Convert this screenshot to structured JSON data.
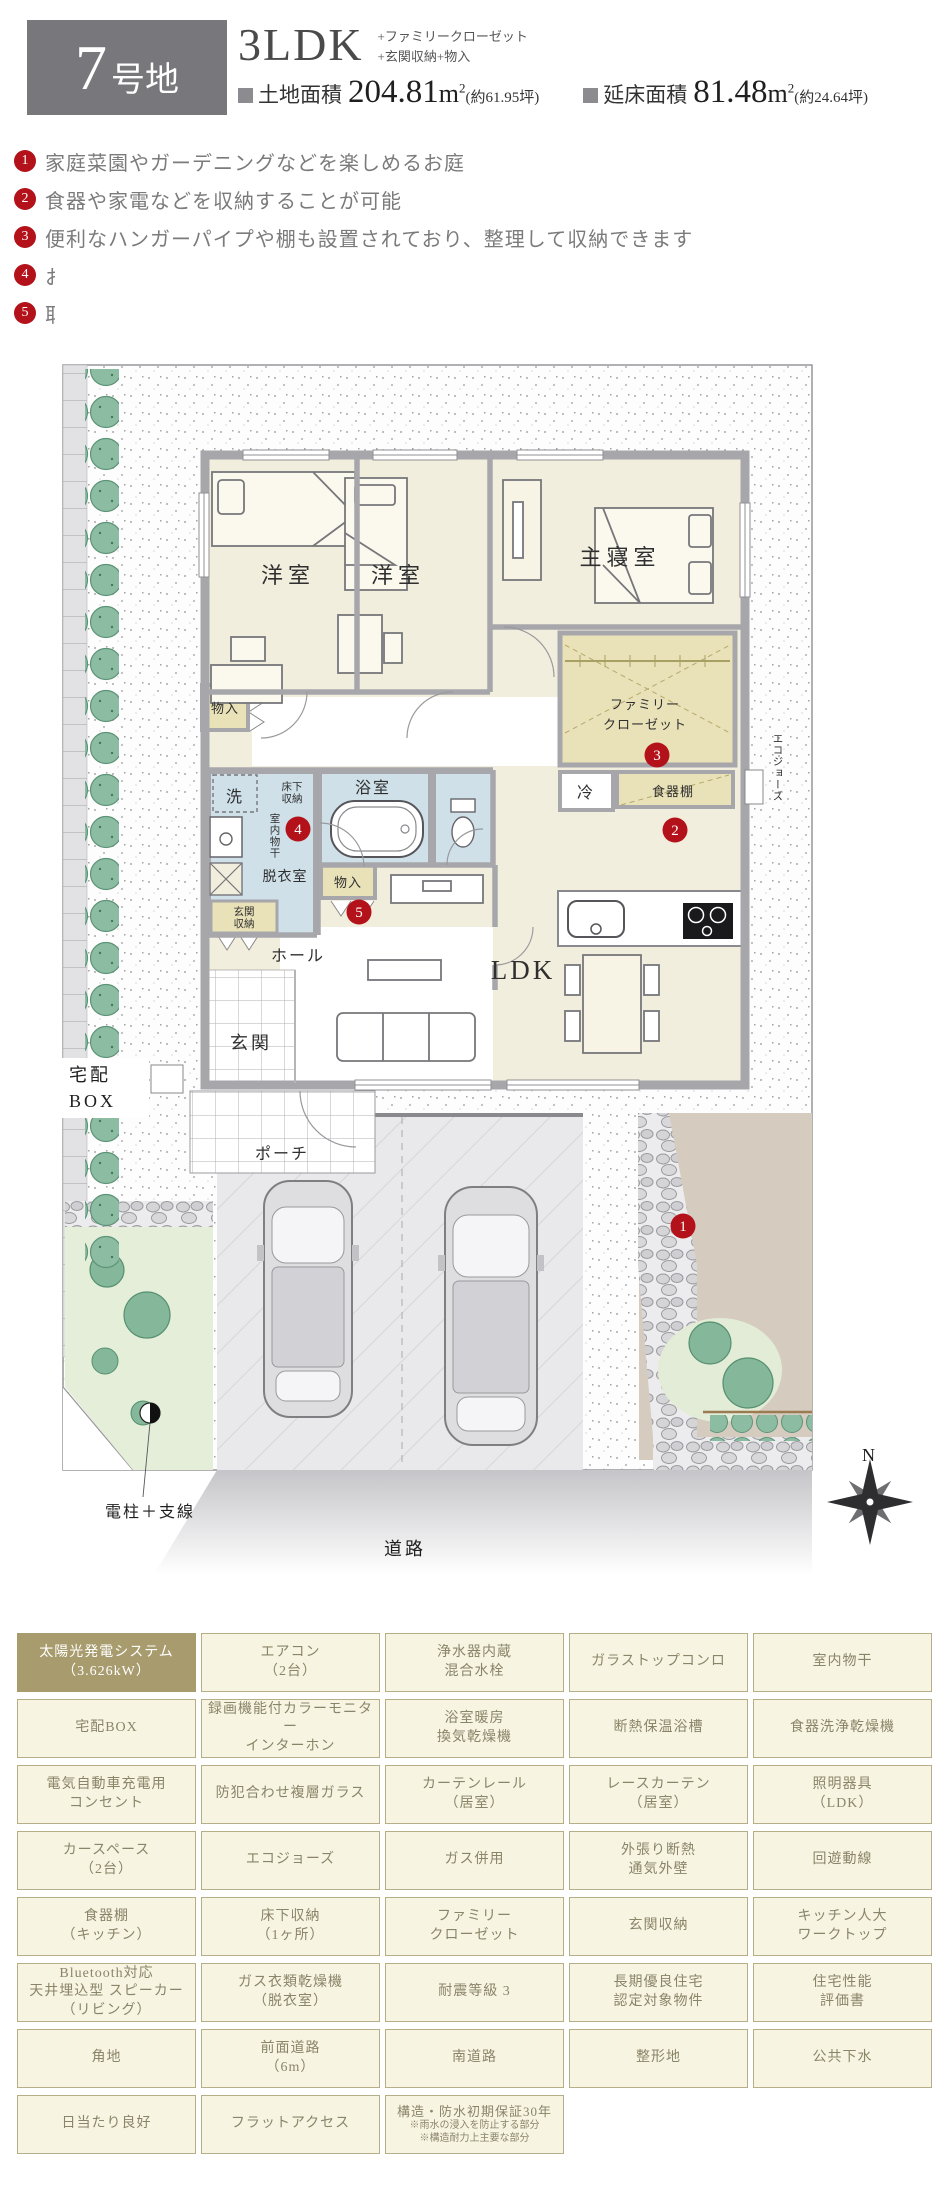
{
  "header": {
    "lot_number": "7",
    "lot_suffix": "号地",
    "plan_type": "3LDK",
    "plan_extra1": "+ファミリークローゼット",
    "plan_extra2": "+玄関収納+物入",
    "land_label": "土地面積",
    "land_value": "204.81",
    "unit": "m",
    "unit_sup": "2",
    "land_tsubo": "(約61.95坪)",
    "floor_label": "延床面積",
    "floor_value": "81.48",
    "floor_tsubo": "(約24.64坪)"
  },
  "features_list": [
    {
      "num": "1",
      "text": "家庭菜園やガーデニングなどを楽しめるお庭"
    },
    {
      "num": "2",
      "text": "食器や家電などを収納することが可能"
    },
    {
      "num": "3",
      "text": "便利なハンガーパイプや棚も設置されており、整理して収納できます"
    },
    {
      "num": "4",
      "text": "お天気が悪い日にも、洗濯物を干す場所に困らない室内物干"
    },
    {
      "num": "5",
      "text": "取り出しやすく、室内を綺麗に整理するのに役立つ物入"
    }
  ],
  "plan": {
    "yoshitsu": "洋室",
    "shushinshitsu": "主寝室",
    "fc1": "ファミリー",
    "fc2": "クローゼット",
    "rei": "冷",
    "shokkidana": "食器棚",
    "eco": "エコジョーズ",
    "monoire": "物入",
    "sen": "洗",
    "yukashita1": "床下",
    "yukashita2": "収納",
    "indoor_dry": "室内物干",
    "datsui": "脱衣室",
    "yokushitsu": "浴室",
    "gshuno1": "玄関",
    "gshuno2": "収納",
    "hall": "ホール",
    "genkan": "玄関",
    "porch": "ポーチ",
    "takuhai1": "宅配",
    "takuhai2": "BOX",
    "ldk": "LDK",
    "road": "道路",
    "pole": "電柱＋支線",
    "north": "N"
  },
  "features_table": {
    "cells": [
      {
        "lines": [
          "太陽光発電システム",
          "（3.626kW）"
        ]
      },
      {
        "lines": [
          "エアコン",
          "（2台）"
        ]
      },
      {
        "lines": [
          "浄水器内蔵",
          "混合水栓"
        ]
      },
      {
        "lines": [
          "ガラストップコンロ"
        ]
      },
      {
        "lines": [
          "室内物干"
        ]
      },
      {
        "lines": [
          "宅配BOX"
        ]
      },
      {
        "lines": [
          "録画機能付カラーモニター",
          "インターホン"
        ]
      },
      {
        "lines": [
          "浴室暖房",
          "換気乾燥機"
        ]
      },
      {
        "lines": [
          "断熱保温浴槽"
        ]
      },
      {
        "lines": [
          "食器洗浄乾燥機"
        ]
      },
      {
        "lines": [
          "電気自動車充電用",
          "コンセント"
        ]
      },
      {
        "lines": [
          "防犯合わせ複層ガラス"
        ]
      },
      {
        "lines": [
          "カーテンレール",
          "（居室）"
        ]
      },
      {
        "lines": [
          "レースカーテン",
          "（居室）"
        ]
      },
      {
        "lines": [
          "照明器具",
          "（LDK）"
        ]
      },
      {
        "lines": [
          "カースペース",
          "（2台）"
        ]
      },
      {
        "lines": [
          "エコジョーズ"
        ]
      },
      {
        "lines": [
          "ガス併用"
        ]
      },
      {
        "lines": [
          "外張り断熱",
          "通気外壁"
        ]
      },
      {
        "lines": [
          "回遊動線"
        ]
      },
      {
        "lines": [
          "食器棚",
          "（キッチン）"
        ]
      },
      {
        "lines": [
          "床下収納",
          "（1ヶ所）"
        ]
      },
      {
        "lines": [
          "ファミリー",
          "クローゼット"
        ]
      },
      {
        "lines": [
          "玄関収納"
        ]
      },
      {
        "lines": [
          "キッチン人大",
          "ワークトップ"
        ]
      },
      {
        "lines": [
          "Bluetooth対応",
          "天井埋込型 スピーカー",
          "（リビング）"
        ]
      },
      {
        "lines": [
          "ガス衣類乾燥機",
          "（脱衣室）"
        ]
      },
      {
        "lines": [
          "耐震等級 3"
        ]
      },
      {
        "lines": [
          "長期優良住宅",
          "認定対象物件"
        ]
      },
      {
        "lines": [
          "住宅性能",
          "評価書"
        ]
      },
      {
        "lines": [
          "角地"
        ]
      },
      {
        "lines": [
          "前面道路",
          "（6m）"
        ]
      },
      {
        "lines": [
          "南道路"
        ]
      },
      {
        "lines": [
          "整形地"
        ]
      },
      {
        "lines": [
          "公共下水"
        ]
      },
      {
        "lines": [
          "日当たり良好"
        ]
      },
      {
        "lines": [
          "フラットアクセス"
        ]
      },
      {
        "lines": [
          "構造・防水初期保証30年",
          "※雨水の浸入を防止する部分",
          "※構造耐力上主要な部分"
        ]
      }
    ]
  }
}
